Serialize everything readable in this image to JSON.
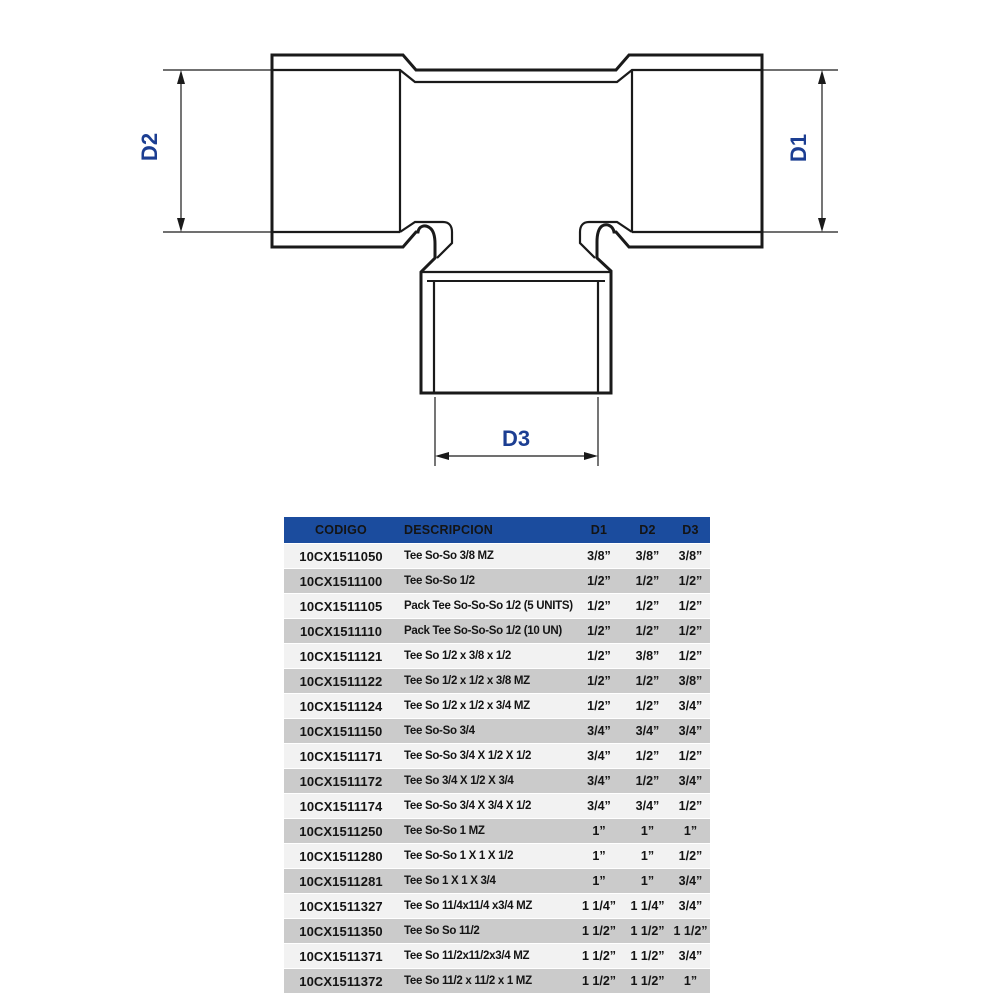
{
  "diagram": {
    "label_d1": "D1",
    "label_d2": "D2",
    "label_d3": "D3",
    "line_color": "#1a1a1a",
    "label_color": "#1c3e92"
  },
  "table": {
    "header_bg": "#1b4c9e",
    "row_light": "#f2f2f2",
    "row_dark": "#cbcbcb",
    "headers": [
      "CODIGO",
      "DESCRIPCION",
      "D1",
      "D2",
      "D3"
    ],
    "rows": [
      {
        "code": "10CX1511050",
        "desc": "Tee So-So 3/8 MZ",
        "d1": "3/8”",
        "d2": "3/8”",
        "d3": "3/8”"
      },
      {
        "code": "10CX1511100",
        "desc": "Tee So-So 1/2",
        "d1": "1/2”",
        "d2": "1/2”",
        "d3": "1/2”"
      },
      {
        "code": "10CX1511105",
        "desc": "Pack Tee So-So-So 1/2 (5 UNITS)",
        "d1": "1/2”",
        "d2": "1/2”",
        "d3": "1/2”"
      },
      {
        "code": "10CX1511110",
        "desc": "Pack Tee So-So-So 1/2 (10 UN)",
        "d1": "1/2”",
        "d2": "1/2”",
        "d3": "1/2”"
      },
      {
        "code": "10CX1511121",
        "desc": "Tee So 1/2 x 3/8 x 1/2",
        "d1": "1/2”",
        "d2": "3/8”",
        "d3": "1/2”"
      },
      {
        "code": "10CX1511122",
        "desc": "Tee So 1/2 x 1/2 x 3/8 MZ",
        "d1": "1/2”",
        "d2": "1/2”",
        "d3": "3/8”"
      },
      {
        "code": "10CX1511124",
        "desc": "Tee So 1/2 x 1/2 x 3/4 MZ",
        "d1": "1/2”",
        "d2": "1/2”",
        "d3": "3/4”"
      },
      {
        "code": "10CX1511150",
        "desc": "Tee So-So 3/4",
        "d1": "3/4”",
        "d2": "3/4”",
        "d3": "3/4”"
      },
      {
        "code": "10CX1511171",
        "desc": "Tee So-So 3/4 X 1/2 X 1/2",
        "d1": "3/4”",
        "d2": "1/2”",
        "d3": "1/2”"
      },
      {
        "code": "10CX1511172",
        "desc": "Tee So 3/4 X 1/2 X 3/4",
        "d1": "3/4”",
        "d2": "1/2”",
        "d3": "3/4”"
      },
      {
        "code": "10CX1511174",
        "desc": "Tee So-So 3/4 X 3/4 X 1/2",
        "d1": "3/4”",
        "d2": "3/4”",
        "d3": "1/2”"
      },
      {
        "code": "10CX1511250",
        "desc": "Tee So-So 1 MZ",
        "d1": "1”",
        "d2": "1”",
        "d3": "1”"
      },
      {
        "code": "10CX1511280",
        "desc": "Tee So-So 1 X 1 X 1/2",
        "d1": "1”",
        "d2": "1”",
        "d3": "1/2”"
      },
      {
        "code": "10CX1511281",
        "desc": "Tee So 1 X 1 X 3/4",
        "d1": "1”",
        "d2": "1”",
        "d3": "3/4”"
      },
      {
        "code": "10CX1511327",
        "desc": "Tee So 11/4x11/4 x3/4 MZ",
        "d1": "1 1/4”",
        "d2": "1 1/4”",
        "d3": "3/4”"
      },
      {
        "code": "10CX1511350",
        "desc": "Tee So So 11/2",
        "d1": "1 1/2”",
        "d2": "1 1/2”",
        "d3": "1 1/2”"
      },
      {
        "code": "10CX1511371",
        "desc": "Tee So 11/2x11/2x3/4 MZ",
        "d1": "1 1/2”",
        "d2": "1 1/2”",
        "d3": "3/4”"
      },
      {
        "code": "10CX1511372",
        "desc": "Tee So 11/2 x 11/2 x 1 MZ",
        "d1": "1 1/2”",
        "d2": "1 1/2”",
        "d3": "1”"
      }
    ]
  }
}
